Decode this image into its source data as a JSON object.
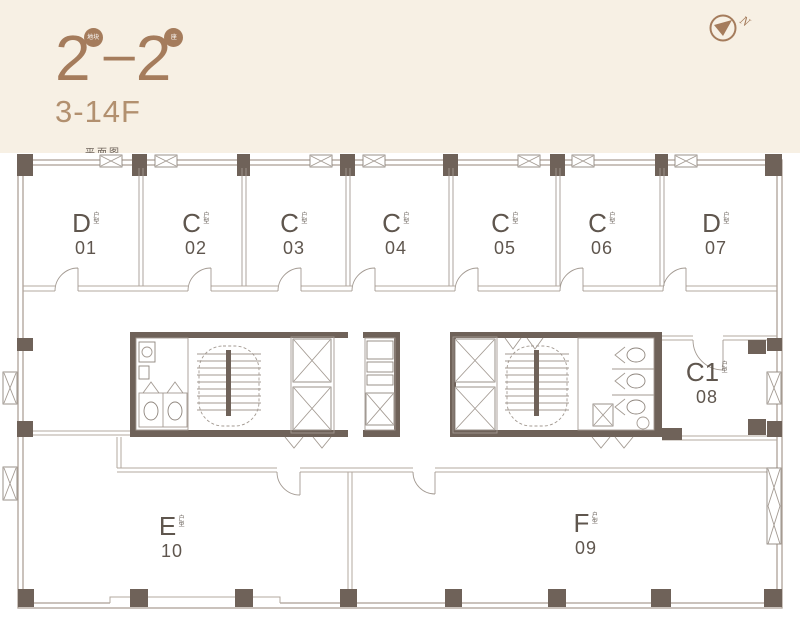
{
  "header": {
    "block_number": "2",
    "block_badge": "地块",
    "separator": "–",
    "tower_number": "2",
    "tower_badge": "座",
    "floors": "3-14F",
    "caption": "平面图",
    "compass_label": "N"
  },
  "colors": {
    "page_bg": "#f7f0e4",
    "plan_bg": "#ffffff",
    "accent": "#a57c5c",
    "wall": "#b3a89f",
    "wall_dark": "#6f6259",
    "label_text": "#5f564e"
  },
  "units": [
    {
      "letter": "D",
      "tag": "户型",
      "number": "01"
    },
    {
      "letter": "C",
      "tag": "户型",
      "number": "02"
    },
    {
      "letter": "C",
      "tag": "户型",
      "number": "03"
    },
    {
      "letter": "C",
      "tag": "户型",
      "number": "04"
    },
    {
      "letter": "C",
      "tag": "户型",
      "number": "05"
    },
    {
      "letter": "C",
      "tag": "户型",
      "number": "06"
    },
    {
      "letter": "D",
      "tag": "户型",
      "number": "07"
    },
    {
      "letter": "C1",
      "tag": "户型",
      "number": "08"
    },
    {
      "letter": "F",
      "tag": "户型",
      "number": "09"
    },
    {
      "letter": "E",
      "tag": "户型",
      "number": "10"
    }
  ]
}
